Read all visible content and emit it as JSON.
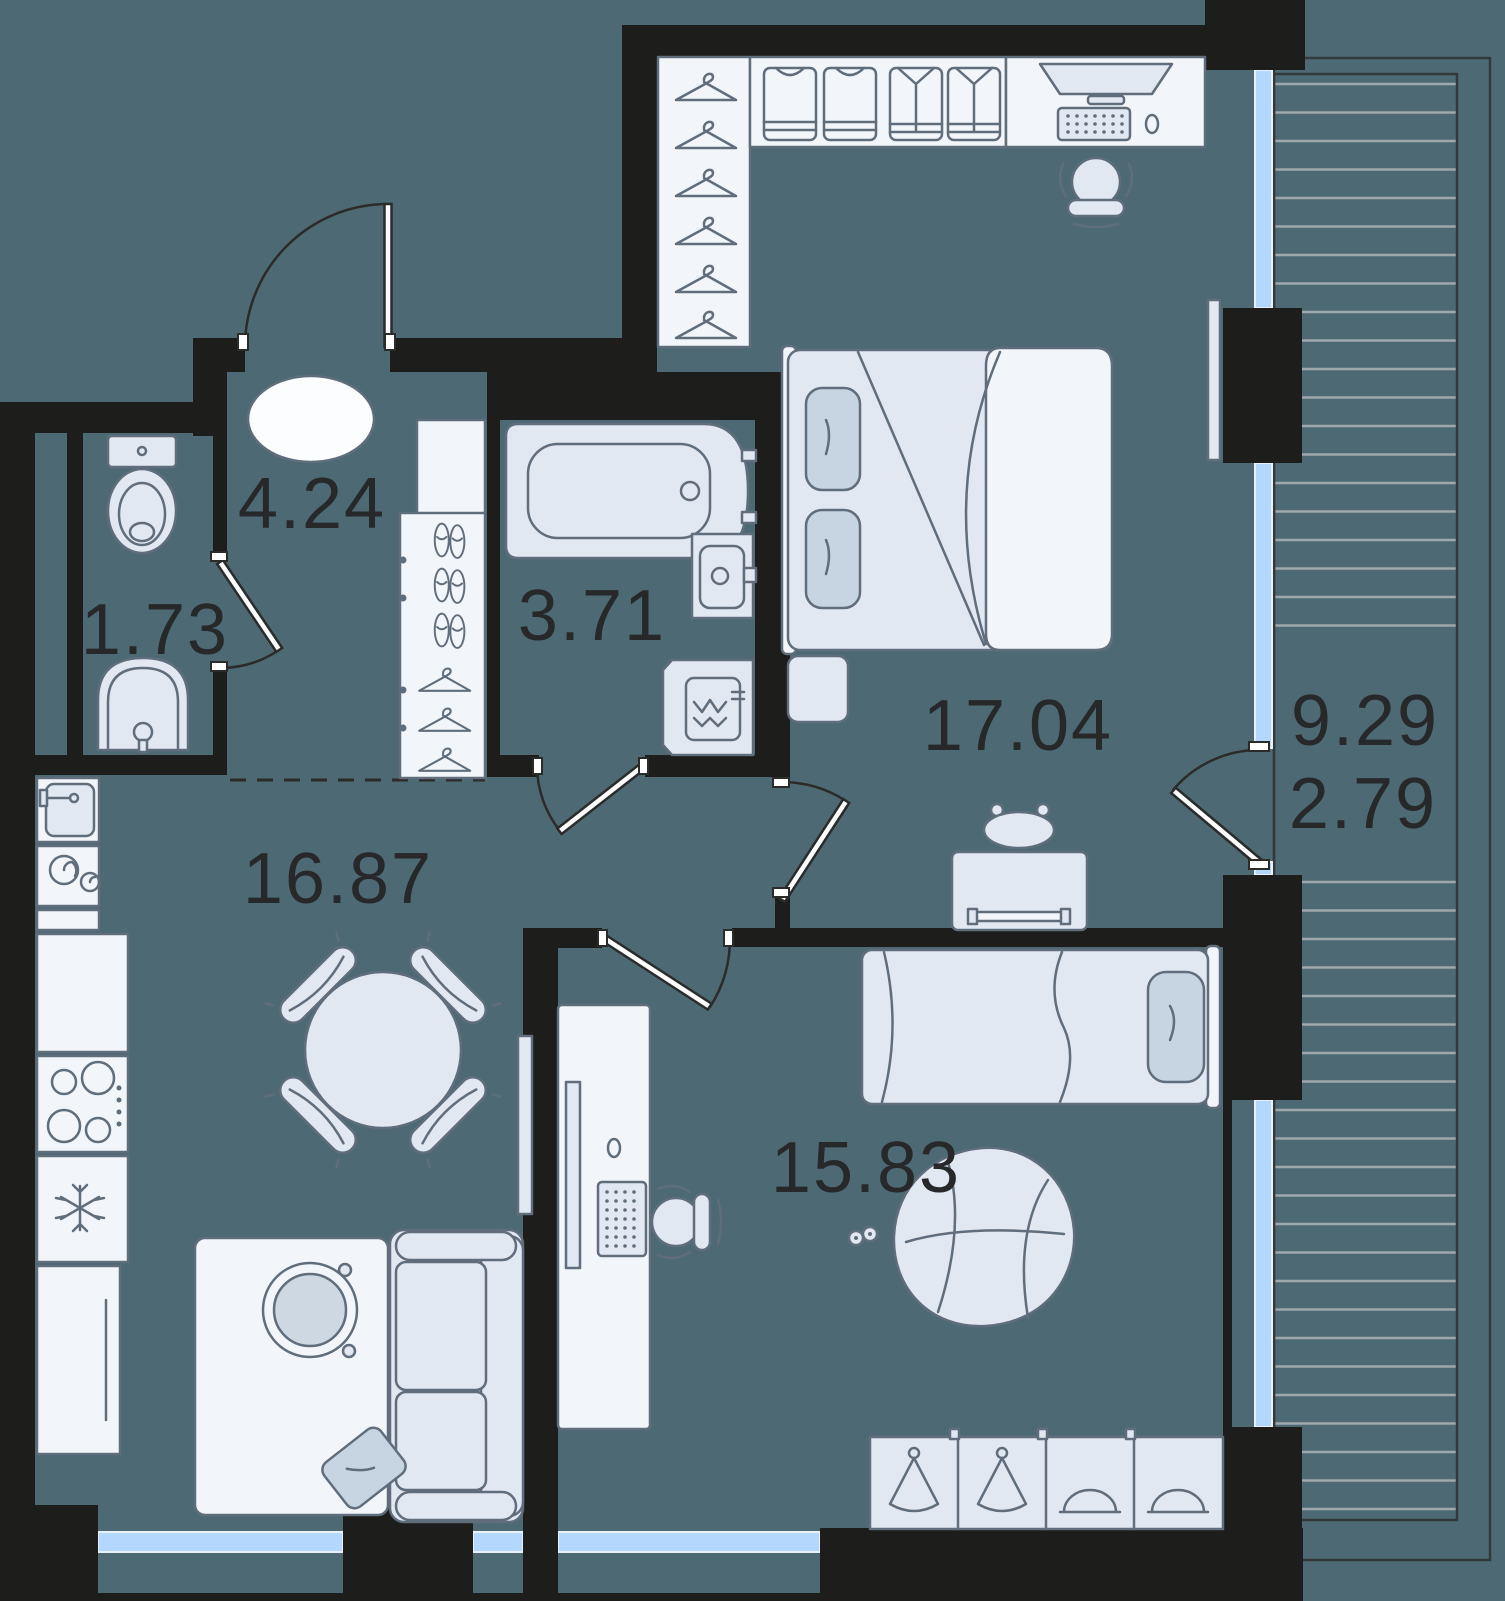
{
  "rooms": {
    "wc": {
      "label": "1.73"
    },
    "hallway": {
      "label": "4.24"
    },
    "bathroom": {
      "label": "3.71"
    },
    "bedroom": {
      "label": "17.04"
    },
    "living": {
      "label": "16.87"
    },
    "bedroom2": {
      "label": "15.83"
    },
    "balcony": {
      "label_total": "9.29",
      "label_reduced": "2.79"
    }
  },
  "colors": {
    "background": "#4d6a74",
    "wall": "#1d1d1b",
    "furniture-fill": "#e2e8f1",
    "furniture-light": "#f2f6fa",
    "furniture-stroke": "#5f6d7c",
    "pillow-fill": "#c7d5e3",
    "glazing-fill": "#b4d7fd",
    "deck-line": "#9fa8ac",
    "label-color": "#26282a"
  },
  "icons": {
    "hanger": "hanger-icon",
    "tshirt": "tshirt-icon",
    "shirt": "shirt-icon",
    "shoes": "shoes-icon",
    "monitor": "monitor-icon",
    "keyboard": "keyboard-icon",
    "mouse": "mouse-icon",
    "snowflake": "snowflake-icon",
    "gamepad": "gamepad-icon"
  }
}
